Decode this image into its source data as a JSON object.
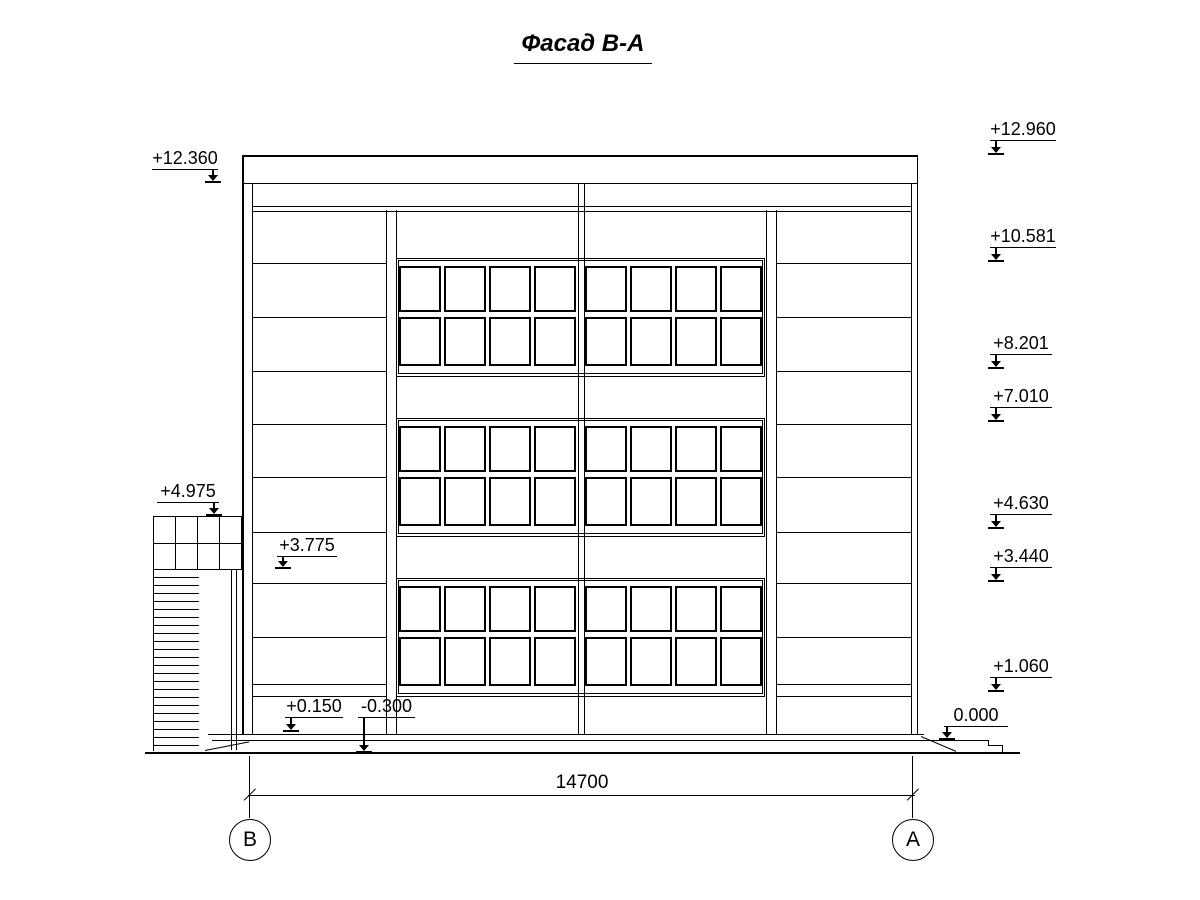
{
  "title": "Фасад В-А",
  "marks": {
    "m12360": "+12.360",
    "m12960": "+12.960",
    "m10581": "+10.581",
    "m8201": "+8.201",
    "m7010": "+7.010",
    "m4975": "+4.975",
    "m4630": "+4.630",
    "m3775": "+3.775",
    "m3440": "+3.440",
    "m1060": "+1.060",
    "m0150": "+0.150",
    "mn0300": "-0.300",
    "m0000": "0.000"
  },
  "dimension": {
    "value": "14700"
  },
  "axes": {
    "left": "В",
    "right": "А"
  },
  "colors": {
    "line": "#000000",
    "background": "#ffffff"
  }
}
